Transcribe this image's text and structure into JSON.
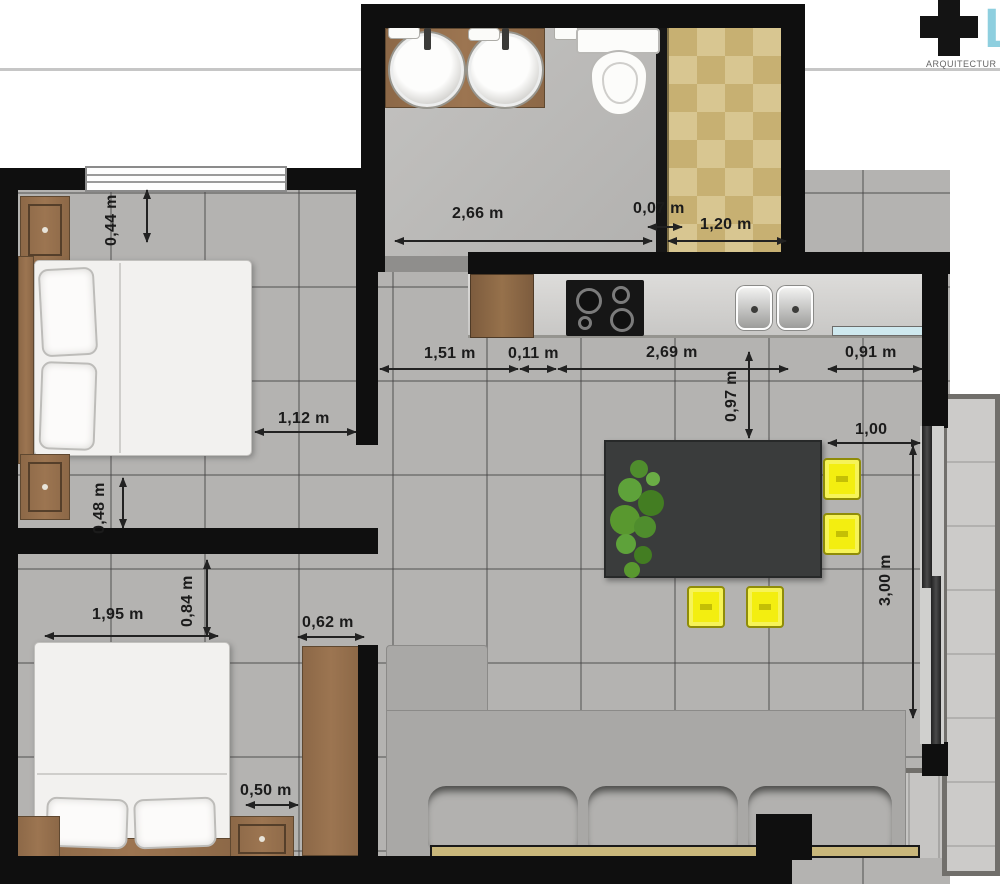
{
  "logo": {
    "mark": "+",
    "letter": "L",
    "subtitle": "ARQUITECTUR"
  },
  "dimensions": {
    "bath_width": "2,66 m",
    "bath_partition": "0,07 m",
    "shower_width": "1,20 m",
    "nightstand_top": "0,44 m",
    "bed1_side_clearance": "1,12 m",
    "bed1_foot_clearance": "0,48 m",
    "counter_left": "1,51 m",
    "counter_gap": "0,11 m",
    "counter_length": "2,69 m",
    "counter_right": "0,91 m",
    "counter_depth": "0,97 m",
    "table_offset": "1,00",
    "living_length": "3,00 m",
    "bed2_width": "1,95 m",
    "bed2_side": "0,84 m",
    "wardrobe_width": "0,62 m",
    "bed2_clearance": "0,50 m"
  },
  "palette": {
    "wall": "#0f0f0f",
    "floor_tile": "#b4b3b1",
    "shower_tile": "#d8c691",
    "wood": "#8c6847",
    "chair_yellow": "#f3ee10",
    "table_dark": "#3a3c3c",
    "window_blue": "#cfe9ef",
    "logo_blue": "#8ecfdf"
  }
}
